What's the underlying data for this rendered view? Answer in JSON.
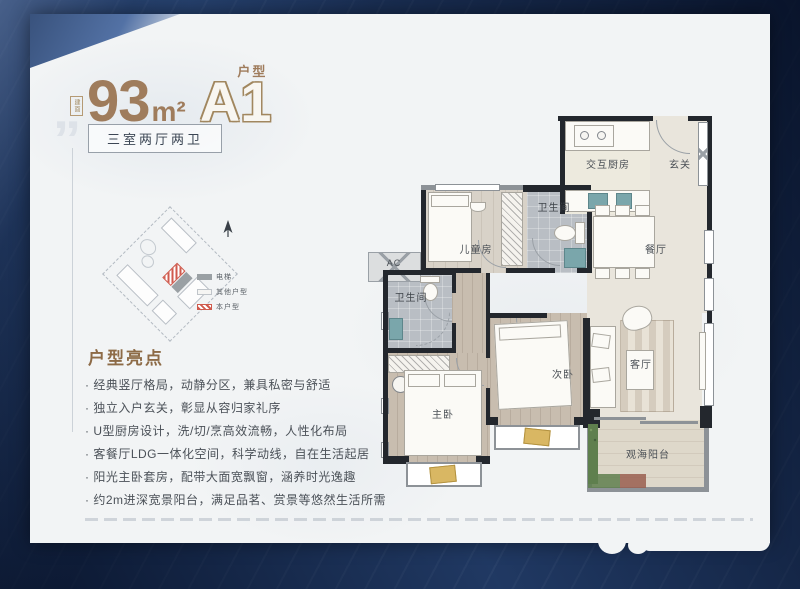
{
  "title": {
    "stamp": "建面",
    "number": "93",
    "unit": "m²",
    "plan_code": "A1",
    "plan_suffix": "户型"
  },
  "badge": {
    "label": "三室两厅两卫"
  },
  "site_plan": {
    "legend": [
      {
        "label": "电梯",
        "style": "solid"
      },
      {
        "label": "其他户型",
        "style": "outline"
      },
      {
        "label": "本户型",
        "style": "hatched"
      }
    ]
  },
  "highlights": {
    "heading": "户型亮点",
    "items": [
      "经典竖厅格局，动静分区，兼具私密与舒适",
      "独立入户玄关，彰显从容归家礼序",
      "U型厨房设计，洗/切/烹高效流畅，人性化布局",
      "客餐厅LDG一体化空间，科学动线，自在生活起居",
      "阳光主卧套房，配带大面宽飘窗，涵养时光逸趣",
      "约2m进深宽景阳台，满足品茗、赏景等悠然生活所需"
    ]
  },
  "floorplan": {
    "rooms": {
      "kitchen": "交互厨房",
      "foyer": "玄关",
      "bath_top": "卫生间",
      "bath_left": "卫生间",
      "kids": "儿童房",
      "dining": "餐厅",
      "second_bed": "次卧",
      "master_bed": "主卧",
      "living": "客厅",
      "balcony": "观海阳台",
      "ac": "AC"
    }
  },
  "colors": {
    "frame_navy": "#14274a",
    "accent_brown": "#9f7c5c",
    "wall_black": "#23272d",
    "window_gray": "#8d9297",
    "cushion_yellow": "#d9b763",
    "plant_green": "#5f7f4e",
    "unit_red": "#cf5a4c"
  }
}
